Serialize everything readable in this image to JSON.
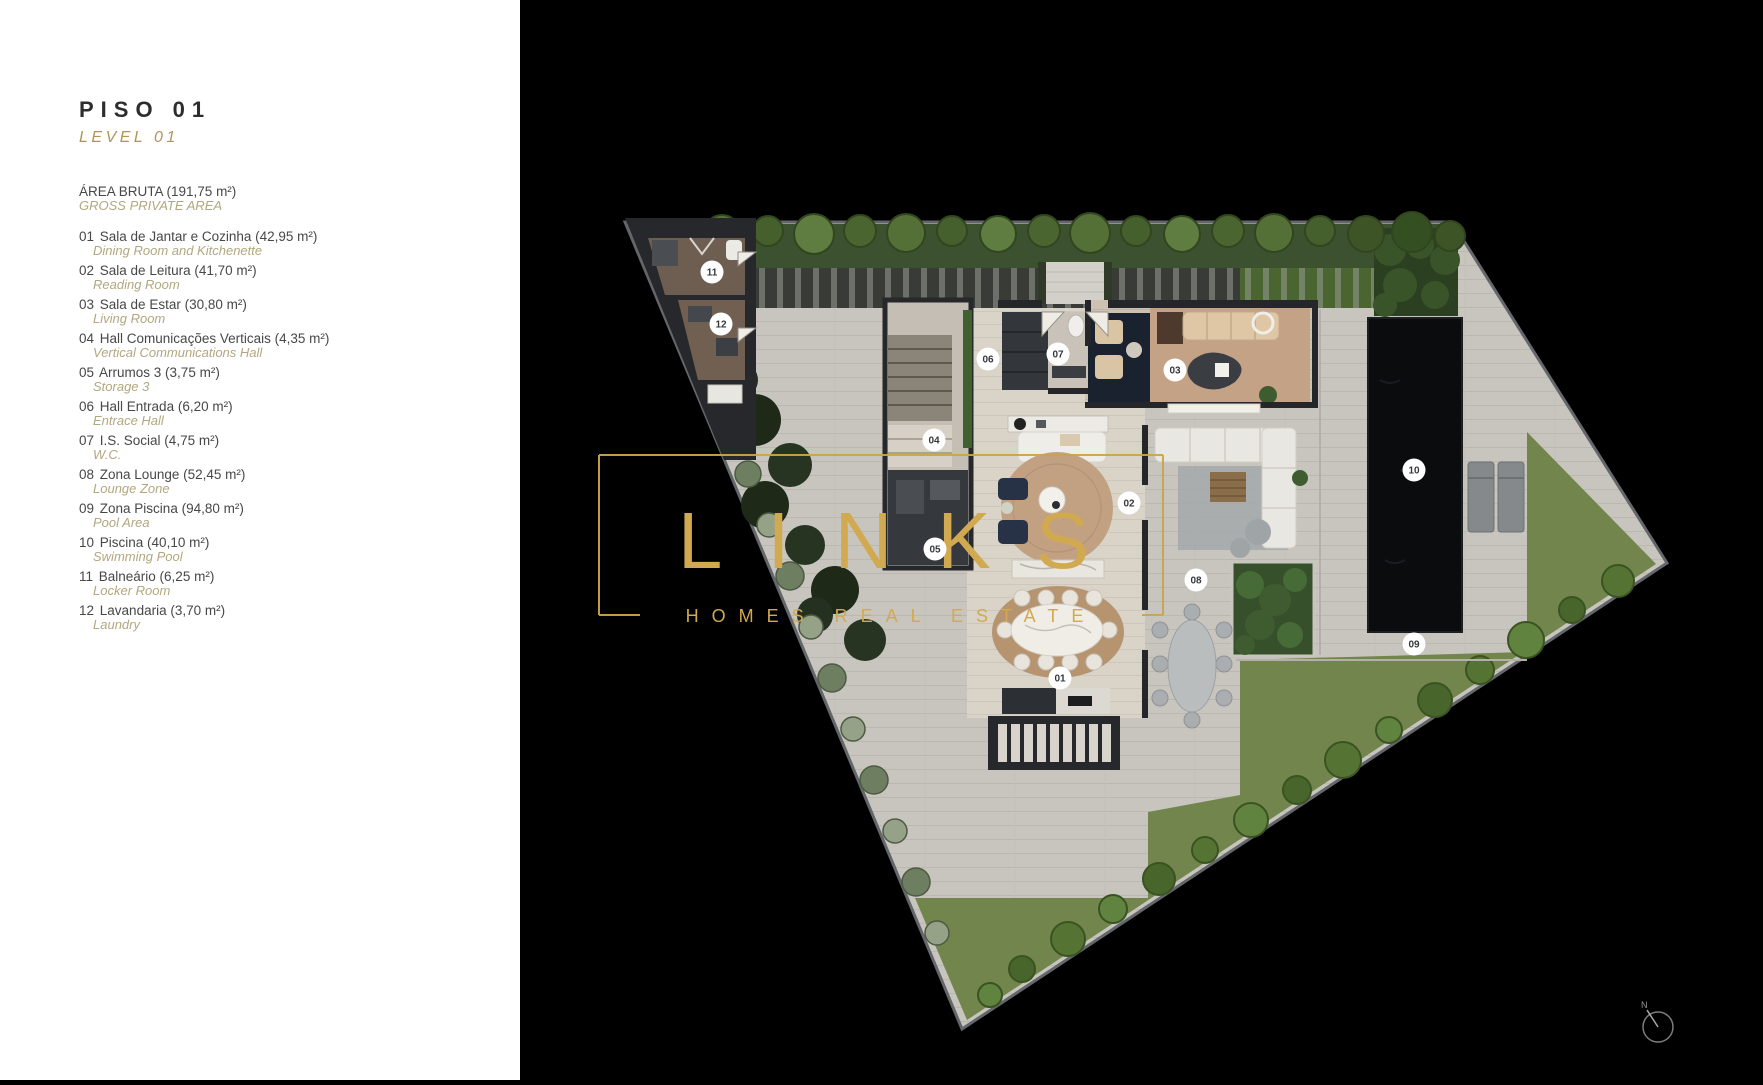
{
  "panel": {
    "title": "PISO 01",
    "subtitle": "LEVEL 01",
    "area_pt": "ÁREA BRUTA (191,75 m²)",
    "area_en": "GROSS PRIVATE AREA",
    "rooms": [
      {
        "num": "01",
        "pt": "Sala de Jantar e Cozinha (42,95 m²)",
        "en": "Dining Room and Kitchenette"
      },
      {
        "num": "02",
        "pt": "Sala de Leitura (41,70 m²)",
        "en": "Reading Room"
      },
      {
        "num": "03",
        "pt": "Sala de Estar (30,80 m²)",
        "en": "Living Room"
      },
      {
        "num": "04",
        "pt": "Hall Comunicações Verticais (4,35 m²)",
        "en": "Vertical Communications Hall"
      },
      {
        "num": "05",
        "pt": "Arrumos 3 (3,75 m²)",
        "en": "Storage 3"
      },
      {
        "num": "06",
        "pt": "Hall Entrada (6,20 m²)",
        "en": "Entrace Hall"
      },
      {
        "num": "07",
        "pt": "I.S. Social (4,75 m²)",
        "en": "W.C."
      },
      {
        "num": "08",
        "pt": "Zona Lounge (52,45 m²)",
        "en": "Lounge Zone"
      },
      {
        "num": "09",
        "pt": "Zona Piscina (94,80 m²)",
        "en": "Pool Area"
      },
      {
        "num": "10",
        "pt": "Piscina (40,10 m²)",
        "en": "Swimming Pool"
      },
      {
        "num": "11",
        "pt": "Balneário (6,25 m²)",
        "en": "Locker Room"
      },
      {
        "num": "12",
        "pt": "Lavandaria (3,70 m²)",
        "en": "Laundry"
      }
    ]
  },
  "watermark": {
    "brand": "LINKS",
    "tagline": "HOMES REAL ESTATE",
    "color": "#d1a950"
  },
  "compass": {
    "label": "N"
  },
  "markers": [
    {
      "id": "01",
      "x": 540,
      "y": 678
    },
    {
      "id": "02",
      "x": 609,
      "y": 503
    },
    {
      "id": "03",
      "x": 655,
      "y": 370
    },
    {
      "id": "04",
      "x": 414,
      "y": 440
    },
    {
      "id": "05",
      "x": 415,
      "y": 549
    },
    {
      "id": "06",
      "x": 468,
      "y": 359
    },
    {
      "id": "07",
      "x": 538,
      "y": 354
    },
    {
      "id": "08",
      "x": 676,
      "y": 580
    },
    {
      "id": "09",
      "x": 894,
      "y": 644
    },
    {
      "id": "10",
      "x": 894,
      "y": 470
    },
    {
      "id": "11",
      "x": 192,
      "y": 272
    },
    {
      "id": "12",
      "x": 201,
      "y": 324
    }
  ],
  "colors": {
    "accent_gold": "#d1a950",
    "panel_bg": "#ffffff",
    "canvas_bg": "#000000"
  }
}
